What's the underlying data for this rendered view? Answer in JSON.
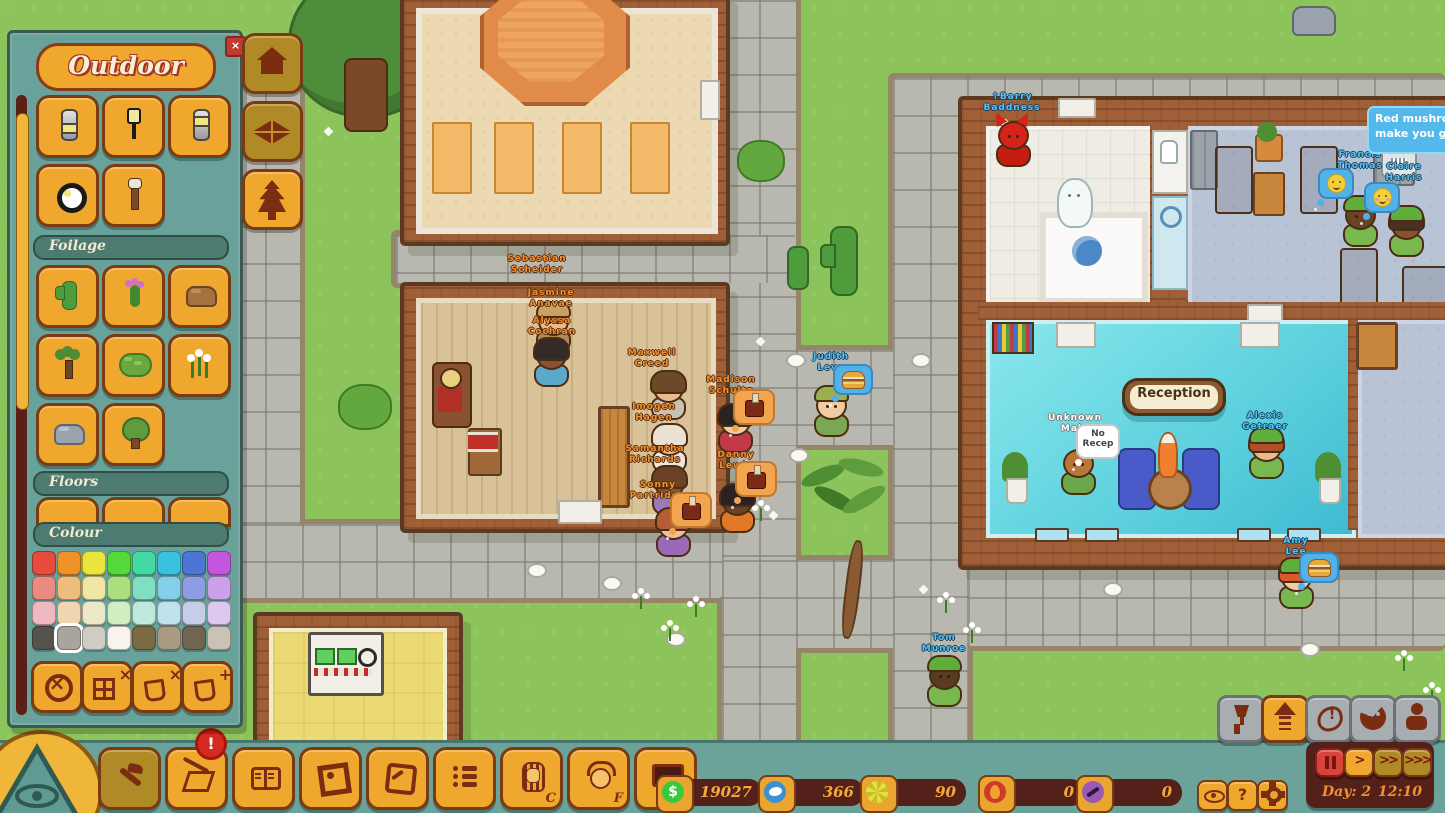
{
  "ui": {
    "panel": {
      "title": "Outdoor",
      "close_label": "×",
      "sections": {
        "foilage": "Foilage",
        "floors": "Floors",
        "colour": "Colour"
      },
      "tools": [
        "cylinder-light",
        "street-lamp",
        "pillar-light",
        "ground-light",
        "torch"
      ],
      "foilage": [
        "cactus",
        "flower-cactus",
        "rock-brown",
        "joshua-tree",
        "bush",
        "flowers-white",
        "rock-gray",
        "tree"
      ],
      "swatches": [
        "#e84a3e",
        "#ef9327",
        "#ece43e",
        "#55d83a",
        "#43d9a2",
        "#39c2e0",
        "#4b76d4",
        "#c257dd",
        "#e98b80",
        "#eebd7e",
        "#efe6a3",
        "#abe07e",
        "#80dfc2",
        "#85cfe9",
        "#8e9ce2",
        "#caa2e9",
        "#efb9c1",
        "#efd5b0",
        "#ede7ca",
        "#cfeec2",
        "#bfe9dd",
        "#c2e1ef",
        "#c5cee9",
        "#ddc9ef",
        "#56524c",
        "#a9a59d",
        "#d0ccc4",
        "#f8f4ec",
        "#7b6b43",
        "#a99b81",
        "#706551",
        "#cac3b5"
      ],
      "selected_swatch": 25,
      "actions": [
        "clear",
        "tile-x",
        "bucket-x",
        "bucket-plus"
      ],
      "action_glyphs": {
        "clear": "×",
        "tile-x": "×",
        "bucket-x": "×",
        "bucket-plus": "+"
      }
    },
    "side_buttons": [
      {
        "name": "home",
        "active": false
      },
      {
        "name": "floors",
        "active": false
      },
      {
        "name": "nature",
        "active": true
      }
    ],
    "toolbar": [
      {
        "name": "hammer",
        "active": true
      },
      {
        "name": "zones",
        "active": false,
        "badge": "!"
      },
      {
        "name": "journal",
        "active": false
      },
      {
        "name": "frame",
        "active": false
      },
      {
        "name": "compass",
        "active": false
      },
      {
        "name": "tasks",
        "active": false
      },
      {
        "name": "pharaoh",
        "active": false,
        "letter": "C"
      },
      {
        "name": "staff-face",
        "active": false,
        "letter": "F"
      },
      {
        "name": "screen",
        "active": false
      }
    ],
    "resources": [
      {
        "name": "money",
        "value": "19027",
        "color": "#3cc83c",
        "glyph": "$"
      },
      {
        "name": "bird",
        "value": "366",
        "color": "#3b8fd4",
        "glyph": ""
      },
      {
        "name": "pinwheel",
        "value": "90",
        "color": "#e8de3c",
        "glyph": ""
      },
      {
        "name": "fire",
        "value": "0",
        "color": "#d03a28",
        "glyph": ""
      },
      {
        "name": "telescope",
        "value": "0",
        "color": "#9b59b6",
        "glyph": ""
      }
    ],
    "mini_buttons": [
      {
        "name": "view",
        "label": ""
      },
      {
        "name": "help",
        "label": "?"
      },
      {
        "name": "settings",
        "label": ""
      }
    ],
    "status_buttons": [
      {
        "name": "fragile",
        "active": false
      },
      {
        "name": "upgrade",
        "active": true
      },
      {
        "name": "hunger",
        "active": false
      },
      {
        "name": "mood",
        "active": false
      },
      {
        "name": "injury",
        "active": false
      }
    ],
    "time_controls": [
      {
        "name": "pause",
        "label": "",
        "style": "red"
      },
      {
        "name": "play",
        "label": ">",
        "style": "active"
      },
      {
        "name": "fast",
        "label": ">>",
        "style": "dim"
      },
      {
        "name": "fastest",
        "label": ">>>",
        "style": "dim"
      }
    ],
    "clock": {
      "day": "Day: 2",
      "time": "12:10"
    }
  },
  "world": {
    "reception_sign": "Reception",
    "tooltip": {
      "line1": "Red mushroo",
      "line2": "make you grow"
    },
    "no_recep": {
      "line1": "No",
      "line2": "Recep"
    },
    "characters": [
      {
        "lines": [
          "Sebastian",
          "Scheider"
        ],
        "type": "staff",
        "nx": 537,
        "ny": 254
      },
      {
        "lines": [
          "Jasmine",
          "Anavae"
        ],
        "type": "staff",
        "nx": 551,
        "ny": 288,
        "bx": 534,
        "by": 304,
        "skin": "#ecb98c",
        "hat": "#c9a263",
        "shirt": "#b08a5a"
      },
      {
        "lines": [
          "Alyssa",
          "Cochran"
        ],
        "type": "staff",
        "nx": 552,
        "ny": 316,
        "bx": 532,
        "by": 338,
        "skin": "#8a5330",
        "hair": "#332b28",
        "shirt": "#58aac8"
      },
      {
        "lines": [
          "Maxwell",
          "Creed"
        ],
        "type": "staff",
        "nx": 652,
        "ny": 348,
        "bx": 649,
        "by": 371,
        "skin": "#ecb98c",
        "hair": "#6b4a2a",
        "shirt": "#c9c2b2"
      },
      {
        "lines": [
          "Imogen",
          "Hagen"
        ],
        "type": "staff",
        "nx": 654,
        "ny": 402,
        "bx": 650,
        "by": 424,
        "skin": "#ecb98c",
        "hair": "#e9e2d2",
        "shirt": "#eae6dc"
      },
      {
        "lines": [
          "Samantha",
          "Richards"
        ],
        "type": "staff",
        "nx": 655,
        "ny": 444,
        "bx": 650,
        "by": 466,
        "skin": "#8a5330",
        "hair": "#6b4226",
        "shirt": "#9a7ab8"
      },
      {
        "lines": [
          "Sonny",
          "Partridge"
        ],
        "type": "staff",
        "nx": 658,
        "ny": 480,
        "bx": 654,
        "by": 508,
        "skin": "#eec09a",
        "hair": "#b85c38",
        "shirt": "#9a6ab8",
        "bubble": "furnace",
        "ux": 670,
        "uy": 492
      },
      {
        "lines": [
          "Madison",
          "Schultz"
        ],
        "type": "staff",
        "nx": 731,
        "ny": 375,
        "bx": 716,
        "by": 404,
        "skin": "#f2cba2",
        "hair": "#2a2220",
        "shirt": "#c23a4a",
        "bubble": "furnace",
        "ux": 733,
        "uy": 389
      },
      {
        "lines": [
          "Danny",
          "Lewis"
        ],
        "type": "staff",
        "nx": 736,
        "ny": 450,
        "bx": 718,
        "by": 484,
        "skin": "#6b4226",
        "hair": "#2a2220",
        "shirt": "#e07828",
        "bubble": "furnace",
        "ux": 735,
        "uy": 461
      },
      {
        "lines": [
          "Judith",
          "Levy"
        ],
        "type": "guest",
        "nx": 831,
        "ny": 352,
        "bx": 812,
        "by": 388,
        "skin": "#f2cba2",
        "hat": "#9ab04c",
        "shirt": "#7aa850",
        "bubble": "burger",
        "ux": 833,
        "uy": 364
      },
      {
        "lines": [
          "↑Barry",
          "Baddness"
        ],
        "type": "guest",
        "nx": 1012,
        "ny": 92,
        "bx": 994,
        "by": 118,
        "variant": "devil"
      },
      {
        "lines": [
          "Francis",
          "Thomas"
        ],
        "type": "guest",
        "nx": 1360,
        "ny": 150,
        "bx": 1341,
        "by": 198,
        "skin": "#6b4226",
        "hat": "#5fae3c",
        "shirt": "#79b84f",
        "bubble": "smiley",
        "ux": 1318,
        "uy": 168
      },
      {
        "lines": [
          "Claire",
          "Harris"
        ],
        "type": "guest",
        "nx": 1404,
        "ny": 162,
        "bx": 1387,
        "by": 208,
        "skin": "#8a5330",
        "hair": "#4a3020",
        "hat": "#5fae3c",
        "shirt": "#79b84f",
        "bubble": "blush",
        "ux": 1364,
        "uy": 182
      },
      {
        "lines": [
          "Unknown",
          "Male"
        ],
        "type": "plain",
        "nx": 1075,
        "ny": 413,
        "bx": 1059,
        "by": 446,
        "skin": "#b8763a",
        "shirt": "#6aa84a",
        "bubble": "norecep",
        "ux": 1076,
        "uy": 424
      },
      {
        "lines": [
          "Alexis",
          "Getraer"
        ],
        "type": "guest",
        "nx": 1265,
        "ny": 411,
        "bx": 1247,
        "by": 430,
        "skin": "#ecb98c",
        "hair": "#b0502a",
        "hat": "#5fae3c",
        "shirt": "#79b84f"
      },
      {
        "lines": [
          "Amy",
          "Lee"
        ],
        "type": "guest",
        "nx": 1296,
        "ny": 536,
        "bx": 1277,
        "by": 560,
        "skin": "#f2cba2",
        "hair": "#d85a28",
        "hat": "#5fae3c",
        "shirt": "#79b84f",
        "bubble": "burger",
        "ux": 1299,
        "uy": 552
      },
      {
        "lines": [
          "Tom",
          "Munroe"
        ],
        "type": "guest",
        "nx": 944,
        "ny": 633,
        "bx": 925,
        "by": 658,
        "skin": "#5a3a22",
        "hat": "#5fae3c",
        "shirt": "#79b84f"
      },
      {
        "type": "npc",
        "bx": 1055,
        "by": 178,
        "variant": "ghost"
      },
      {
        "type": "npc",
        "bx": 1379,
        "by": 130,
        "variant": "robot"
      }
    ],
    "lights": [
      [
        527,
        563
      ],
      [
        602,
        576
      ],
      [
        666,
        632
      ],
      [
        786,
        353
      ],
      [
        911,
        353
      ],
      [
        789,
        448
      ],
      [
        1103,
        582
      ],
      [
        1300,
        642
      ]
    ],
    "flowers": [
      [
        633,
        588
      ],
      [
        662,
        620
      ],
      [
        688,
        596
      ],
      [
        938,
        592
      ],
      [
        964,
        622
      ],
      [
        753,
        500
      ],
      [
        1396,
        650
      ],
      [
        1424,
        682
      ]
    ],
    "sparks": [
      [
        325,
        128
      ],
      [
        770,
        512
      ],
      [
        920,
        586
      ],
      [
        1002,
        120
      ],
      [
        757,
        338
      ]
    ]
  }
}
